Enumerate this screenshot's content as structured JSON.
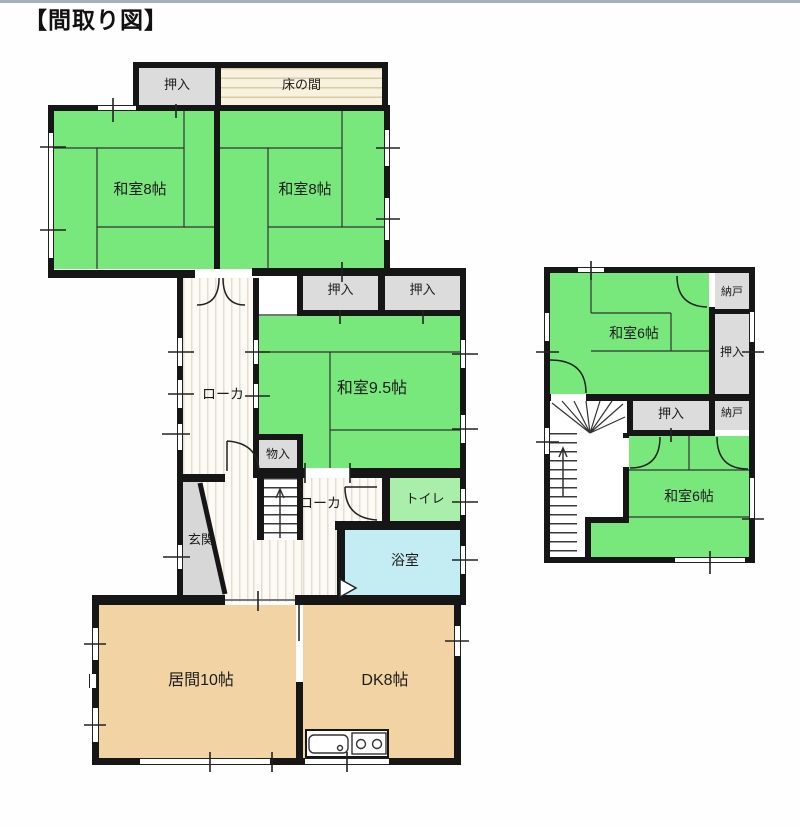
{
  "title": "【間取り図】",
  "floor1": {
    "oshiire_top": "押入",
    "tokonoma": "床の間",
    "washitsu8_left": "和室8帖",
    "washitsu8_right": "和室8帖",
    "oshiire_mid_left": "押入",
    "oshiire_mid_right": "押入",
    "washitsu95": "和室9.5帖",
    "roka_upper": "ローカ",
    "monoire": "物入",
    "roka_lower": "ローカ",
    "toilet": "トイレ",
    "bath": "浴室",
    "genkan": "玄関",
    "living": "居間10帖",
    "dk": "DK8帖"
  },
  "floor2": {
    "washitsu6_upper": "和室6帖",
    "nando_upper": "納戸",
    "oshiire_right": "押入",
    "oshiire_lower": "押入",
    "nando_lower": "納戸",
    "washitsu6_lower": "和室6帖"
  },
  "colors": {
    "tatami_green": "#79e87c",
    "pastel_green": "#a9eeab",
    "bath_cyan": "#c3edf2",
    "wood_tan": "#f2d3a4",
    "closet_gray": "#dcdcdc",
    "tokonoma_cream": "#f7f1dd",
    "wall_black": "#161616",
    "top_rule": "#a6b0bc"
  }
}
